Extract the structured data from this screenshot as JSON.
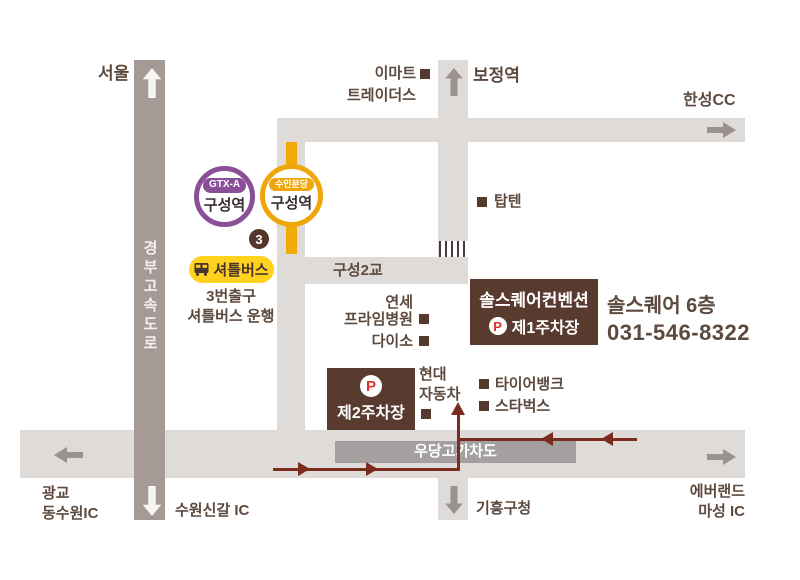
{
  "marker": "■",
  "badges": {
    "gtx_line": "GTX-A",
    "gtx_station": "구성역",
    "suin_line": "수인분당",
    "suin_station": "구성역",
    "exit_number": "3",
    "shuttle_label": "셔틀버스",
    "shuttle_note": "3번출구\n셔틀버스 운행"
  },
  "roads": {
    "expressway": "경부고속도로",
    "bridge": "구성2교",
    "overpass": "우당고가차도"
  },
  "directions": {
    "seoul": "서울",
    "bojeong_station": "보정역",
    "hanseong_cc": "한성CC",
    "gwanggyo": "광교\n동수원IC",
    "suwon_singal": "수원신갈 IC",
    "giheung": "기흥구청",
    "everland": "에버랜드\n마성 IC"
  },
  "landmarks": {
    "emart_l1": "이마트",
    "emart_l2": "트레이더스",
    "topten": "탑텐",
    "yonsei_l1": "연세",
    "yonsei_l2": "프라임병원",
    "daiso": "다이소",
    "hyundai": "현대\n자동차",
    "tirebank": "타이어뱅크",
    "starbucks": "스타벅스"
  },
  "venue": {
    "name": "솔스퀘어컨벤션",
    "parking_symbol": "P",
    "parking1": "제1주차장",
    "parking2": "제2주차장",
    "floor_info": "솔스퀘어 6층",
    "phone": "031-546-8322"
  },
  "colors": {
    "road": "#dfdbd8",
    "expressway": "#a59a96",
    "overpass_box": "#a3a09f",
    "route_red": "#7c2b1f",
    "text_brown": "#5c4a3e",
    "box_brown": "#583a2e",
    "suin_yellow": "#efa60a",
    "shuttle_yellow": "#ffd21e",
    "gtx_purple": "#8a4f96",
    "parking_red": "#e0302a"
  }
}
